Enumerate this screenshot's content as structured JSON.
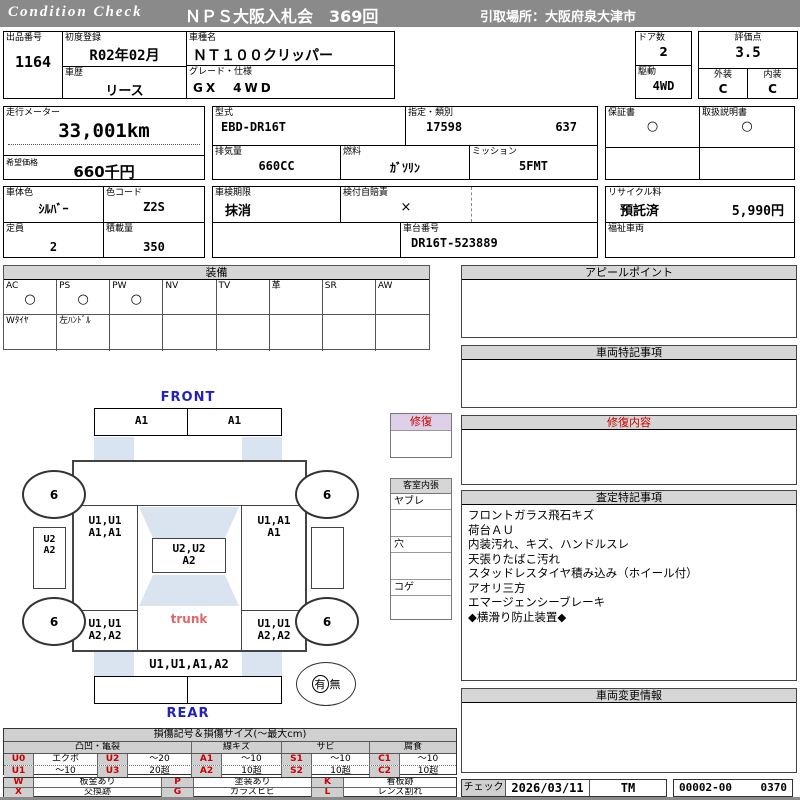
{
  "header": {
    "brand": "Condition  Check",
    "title": "ＮＰＳ大阪入札会　369回",
    "pickup": "引取場所：大阪府泉大津市"
  },
  "info": {
    "lot_label": "出品番号",
    "lot": "1164",
    "first_reg_label": "初度登録",
    "first_reg": "R02年02月",
    "history_label": "車歴",
    "history": "リース",
    "model_label": "車種名",
    "model": "ＮＴ１００クリッパー",
    "grade_label": "グレード・仕様",
    "grade": "GX　4WD",
    "doors_label": "ドア数",
    "doors": "2",
    "drive_label": "駆動",
    "drive": "4WD",
    "score_label": "評価点",
    "score": "3.5",
    "exterior_label": "外装",
    "exterior": "C",
    "interior_label": "内装",
    "interior": "C",
    "odometer_label": "走行メーター",
    "odometer": "33,001km",
    "price_label": "希望価格",
    "price": "660千円",
    "model_code_label": "型式",
    "model_code": "EBD-DR16T",
    "class_label": "指定・類別",
    "class_no": "17598",
    "class_sub": "637",
    "displacement_label": "排気量",
    "displacement": "660CC",
    "fuel_label": "燃料",
    "fuel": "ｶﾞｿﾘﾝ",
    "transmission_label": "ミッション",
    "transmission": "5FMT",
    "warranty_label": "保証書",
    "warranty": "○",
    "manual_label": "取扱説明書",
    "manual": "○",
    "body_color_label": "車体色",
    "body_color": "ｼﾙﾊﾞｰ",
    "color_code_label": "色コード",
    "color_code": "Z2S",
    "capacity_label": "定員",
    "capacity": "2",
    "payload_label": "積載量",
    "payload": "350",
    "inspection_label": "車検期限",
    "inspection": "抹消",
    "insurance_label": "検付自賠責",
    "insurance": "×",
    "chassis_label": "車台番号",
    "chassis": "DR16T-523889",
    "recycle_label": "リサイクル料",
    "recycle_status": "預託済",
    "recycle_fee": "5,990円",
    "welfare_label": "福祉車両"
  },
  "equipment": {
    "title": "装備",
    "cols": [
      "AC",
      "PS",
      "PW",
      "NV",
      "TV",
      "革",
      "SR",
      "AW"
    ],
    "marks": [
      "○",
      "○",
      "○",
      "",
      "",
      "",
      "",
      ""
    ],
    "extras": [
      "Wﾀｲﾔ",
      "左ﾊﾝﾄﾞﾙ",
      "",
      "",
      "",
      "",
      "",
      ""
    ]
  },
  "sections": {
    "appeal_title": "アピールポイント",
    "notes_title": "車両特記事項",
    "repair_title": "修復内容",
    "assessment_title": "査定特記事項",
    "assessment_items": [
      "フロントガラス飛石キズ",
      "荷台ＡＵ",
      "内装汚れ、キズ、ハンドルスレ",
      "天張りたばこ汚れ",
      "スタッドレスタイヤ積み込み（ホイール付）",
      "アオリ三方",
      "エマージェンシーブレーキ",
      "◆横滑り防止装置◆"
    ],
    "change_title": "車両変更情報"
  },
  "middle": {
    "repair_label": "修復",
    "cabin_title": "客室内張",
    "cabin_items": [
      "ヤブレ",
      "穴",
      "コゲ"
    ]
  },
  "diagram": {
    "front_label": "FRONT",
    "rear_label": "REAR",
    "trunk_label": "trunk",
    "front_bumper_left": "A1",
    "front_bumper_right": "A1",
    "left_front_1": "U1,U1",
    "left_front_2": "A1,A1",
    "right_front_1": "U1,A1",
    "right_front_2": "A1",
    "left_door_1": "U2",
    "left_door_2": "A2",
    "roof_1": "U2,U2",
    "roof_2": "A2",
    "left_rear_1": "U1,U1",
    "left_rear_2": "A2,A2",
    "right_rear_1": "U1,U1",
    "right_rear_2": "A2,A2",
    "rear_panel": "U1,U1,A1,A2",
    "wheel_fl": "6",
    "wheel_fr": "6",
    "wheel_rl": "6",
    "wheel_rr": "6",
    "spare_yes": "有",
    "spare_no": "無"
  },
  "legend": {
    "title": "損傷記号＆損傷サイズ(～最大cm)",
    "groups": [
      "凸凹・亀裂",
      "線キズ",
      "サビ",
      "腐食"
    ],
    "row1": [
      "U0",
      "エクボ",
      "U2",
      "～20",
      "A1",
      "～10",
      "S1",
      "～10",
      "C1",
      "～10"
    ],
    "row2": [
      "U1",
      "～10",
      "U3",
      "20超",
      "A2",
      "10超",
      "S2",
      "10超",
      "C2",
      "10超"
    ],
    "row3": [
      "W",
      "板金あり",
      "P",
      "塗装あり",
      "K",
      "看板跡"
    ],
    "row4": [
      "X",
      "交換跡",
      "G",
      "ガラスヒビ",
      "L",
      "レンズ割れ"
    ]
  },
  "footer": {
    "check_label": "チェック",
    "check_date": "2026/03/11",
    "inspector": "TM",
    "doc_no": "00002-00",
    "seq_no": "0370"
  },
  "colors": {
    "accent_red": "#cc0000",
    "header_gray": "#8a8a8a",
    "glass_blue": "#d9e4f0",
    "front_rear_blue": "#2222bb"
  }
}
